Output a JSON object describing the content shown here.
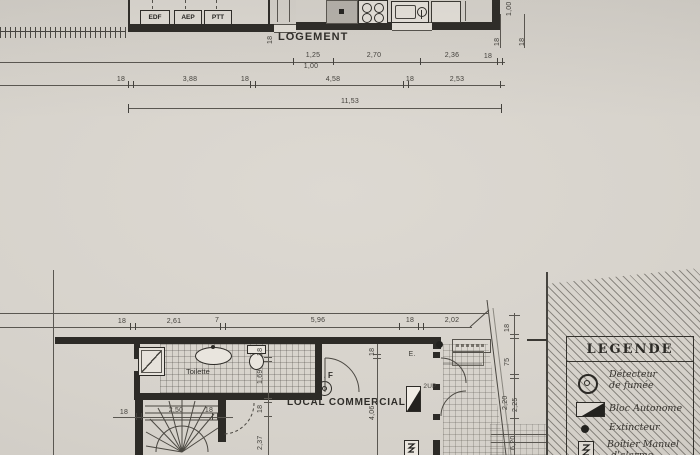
{
  "upper_plan": {
    "room_label": "LOGEMENT",
    "utility_boxes": [
      "EDF",
      "AEP",
      "PTT"
    ],
    "wall_dim": "18",
    "right_dims": {
      "a": "1,00",
      "b": "18",
      "c": "18"
    },
    "dims_row1": {
      "a": "1,25",
      "b": "1,00",
      "c": "2,70",
      "d": "2,36",
      "e": "18"
    },
    "dims_row2": {
      "a": "18",
      "b": "3,88",
      "c": "18",
      "d": "4,58",
      "e": "18",
      "f": "2,53"
    },
    "total_dim": "11,53"
  },
  "lower_plan": {
    "dims_top": {
      "a": "18",
      "b": "2,61",
      "c": "7",
      "d": "5,96",
      "e": "18",
      "f": "2,02"
    },
    "toilette_label": "Toilette",
    "df_label": "D.F",
    "local_label": "LOCAL COMMERCIAL",
    "e_label": "E.",
    "up_label": "2UP",
    "stair_dims": {
      "a": "18",
      "b": "2,50",
      "c": "18"
    },
    "vdims_inner": {
      "a": "18",
      "b": "1,69",
      "c": "18",
      "d": "2,37"
    },
    "vdims_mid": {
      "a": "18",
      "b": "4,06"
    },
    "vdims_right": {
      "a": "18",
      "b": "75",
      "c": "2,20",
      "d": "2,25",
      "e": "6,20"
    }
  },
  "legend": {
    "title": "LEGENDE",
    "items": [
      {
        "icon": "smoke-detector-icon",
        "line1": "Détecteur",
        "line2": "de fumée"
      },
      {
        "icon": "bloc-autonome-icon",
        "line1": "Bloc Autonome",
        "line2": ""
      },
      {
        "icon": "extincteur-icon",
        "line1": "Extincteur",
        "line2": ""
      },
      {
        "icon": "alarm-box-icon",
        "line1": "Boîtier Manuel",
        "line2": "d'alarme"
      }
    ]
  },
  "colors": {
    "ink": "#2d2b27",
    "paper": "#d6d2cb"
  }
}
